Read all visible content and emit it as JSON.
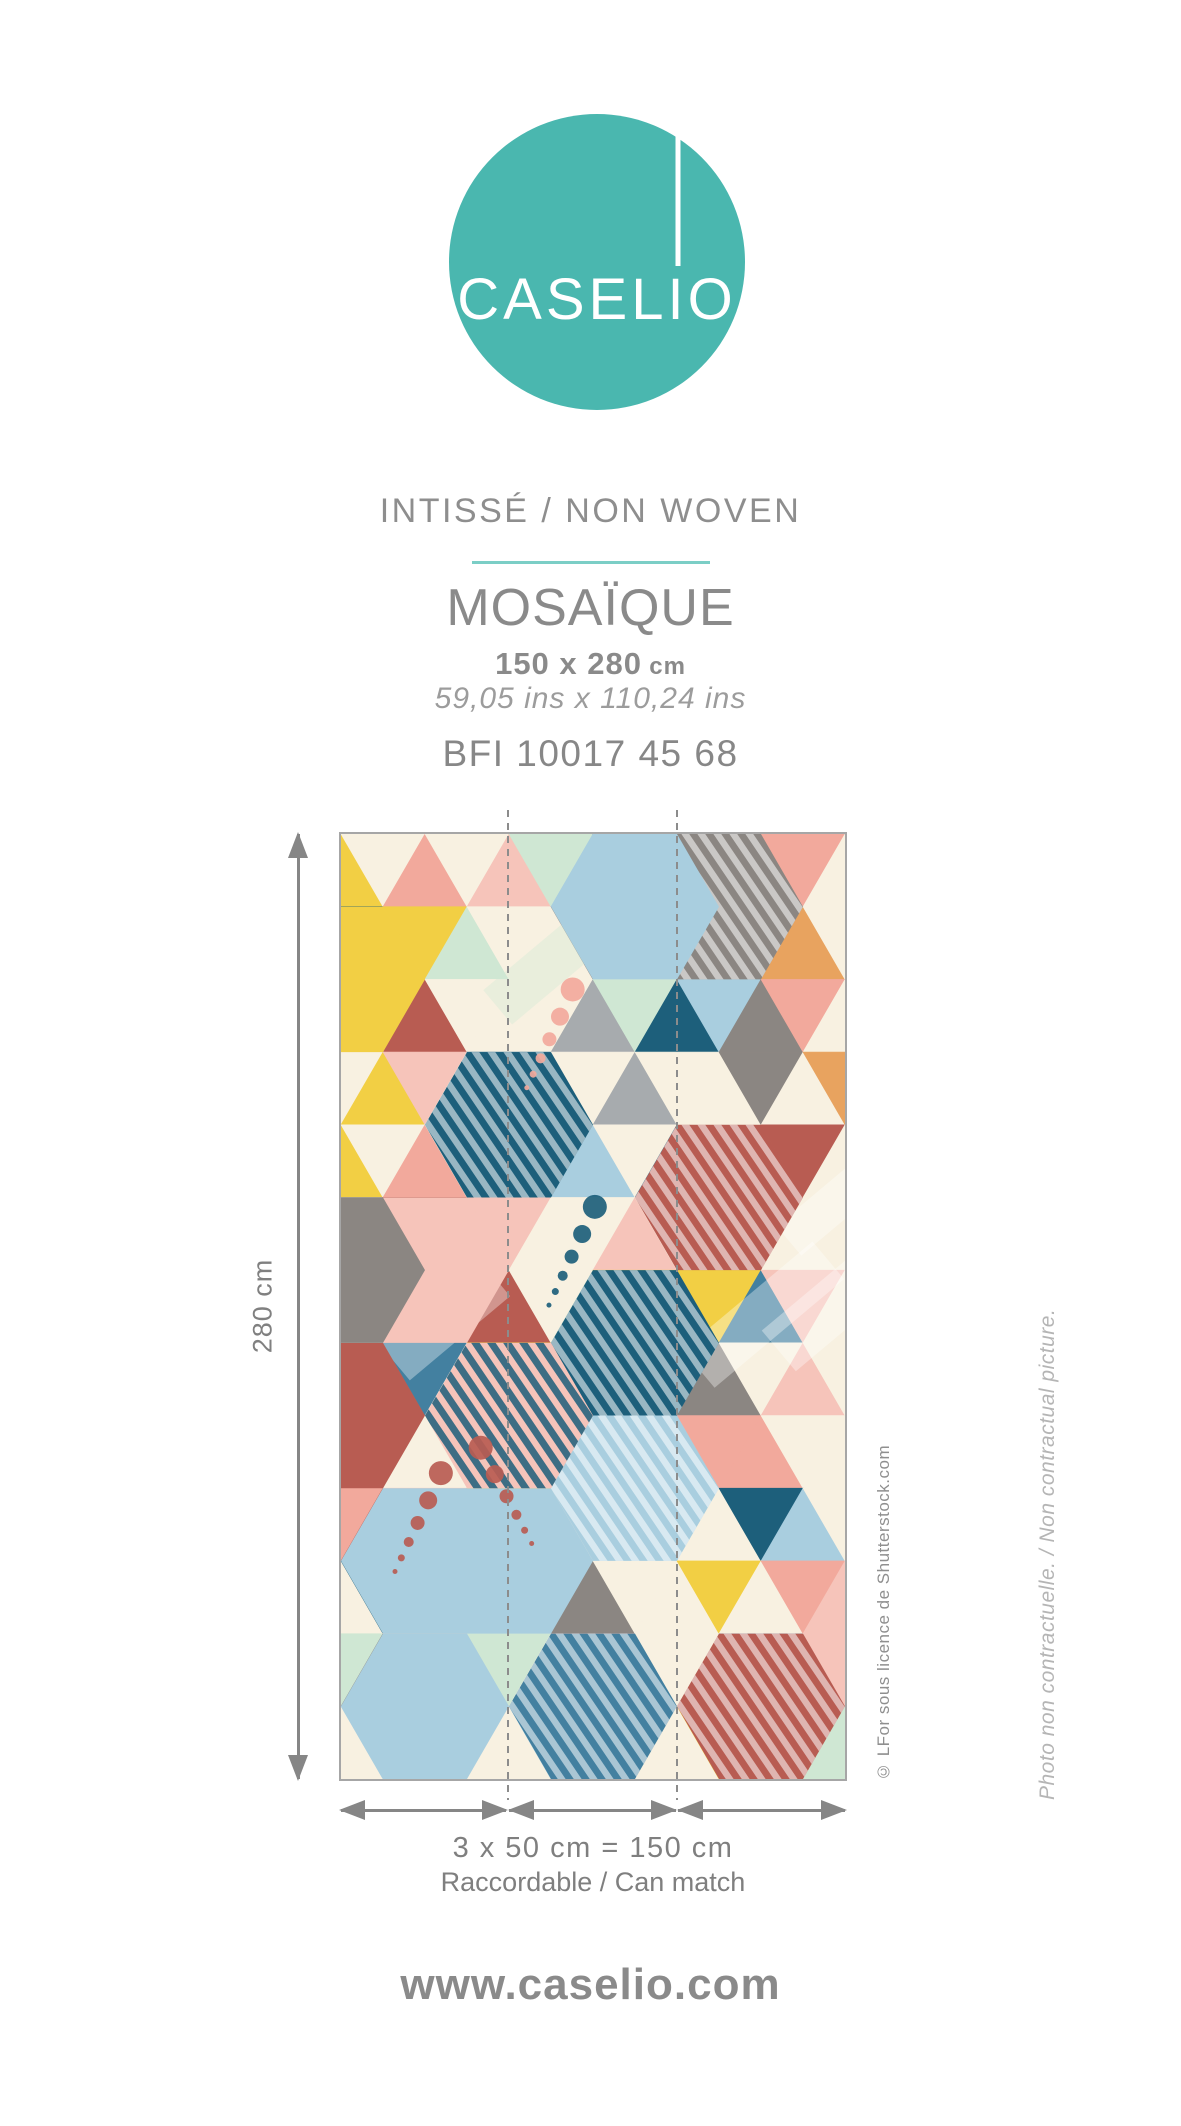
{
  "colors": {
    "brand_teal": "#4ab7af",
    "divider_teal": "#7bcec6",
    "text_gray": "#8a8a8a",
    "dimension_gray": "#868686",
    "seam_dash_gray": "#8c8c8c"
  },
  "logo": {
    "brand_left": "CASEL",
    "brand_i": "I",
    "brand_right": "O"
  },
  "header": {
    "material_line": "INTISSÉ / NON WOVEN",
    "collection_name": "MOSAÏQUE",
    "size_cm_value": "150 x 280",
    "size_cm_unit": "cm",
    "size_ins": "59,05 ins x 110,24 ins",
    "reference": "BFI 10017 45 68"
  },
  "poster": {
    "height_label": "280 cm",
    "width_formula": "3 x 50 cm = 150 cm",
    "match_label": "Raccordable / Can match",
    "credit": "© LFor sous licence de Shutterstock.com",
    "disclaimer": "Photo non contractuelle. / Non contractual picture.",
    "strips": 3,
    "pattern": {
      "type": "memphis-hexagon-mosaic",
      "seed": 5,
      "background": "#f8f1e1",
      "palette": {
        "cream": "#f8f1e1",
        "lightblue": "#a9cedf",
        "steelblue": "#4380a0",
        "petrol": "#1d5f7b",
        "mint": "#cfe7d3",
        "pink": "#f6c4ba",
        "salmon": "#f2a99c",
        "red": "#b85c52",
        "gray": "#8b8682",
        "lightgray": "#a7abae",
        "yellow": "#f2cf44",
        "orange": "#e8a35f",
        "white": "#ffffff"
      }
    }
  },
  "footer": {
    "website": "www.caselio.com"
  }
}
